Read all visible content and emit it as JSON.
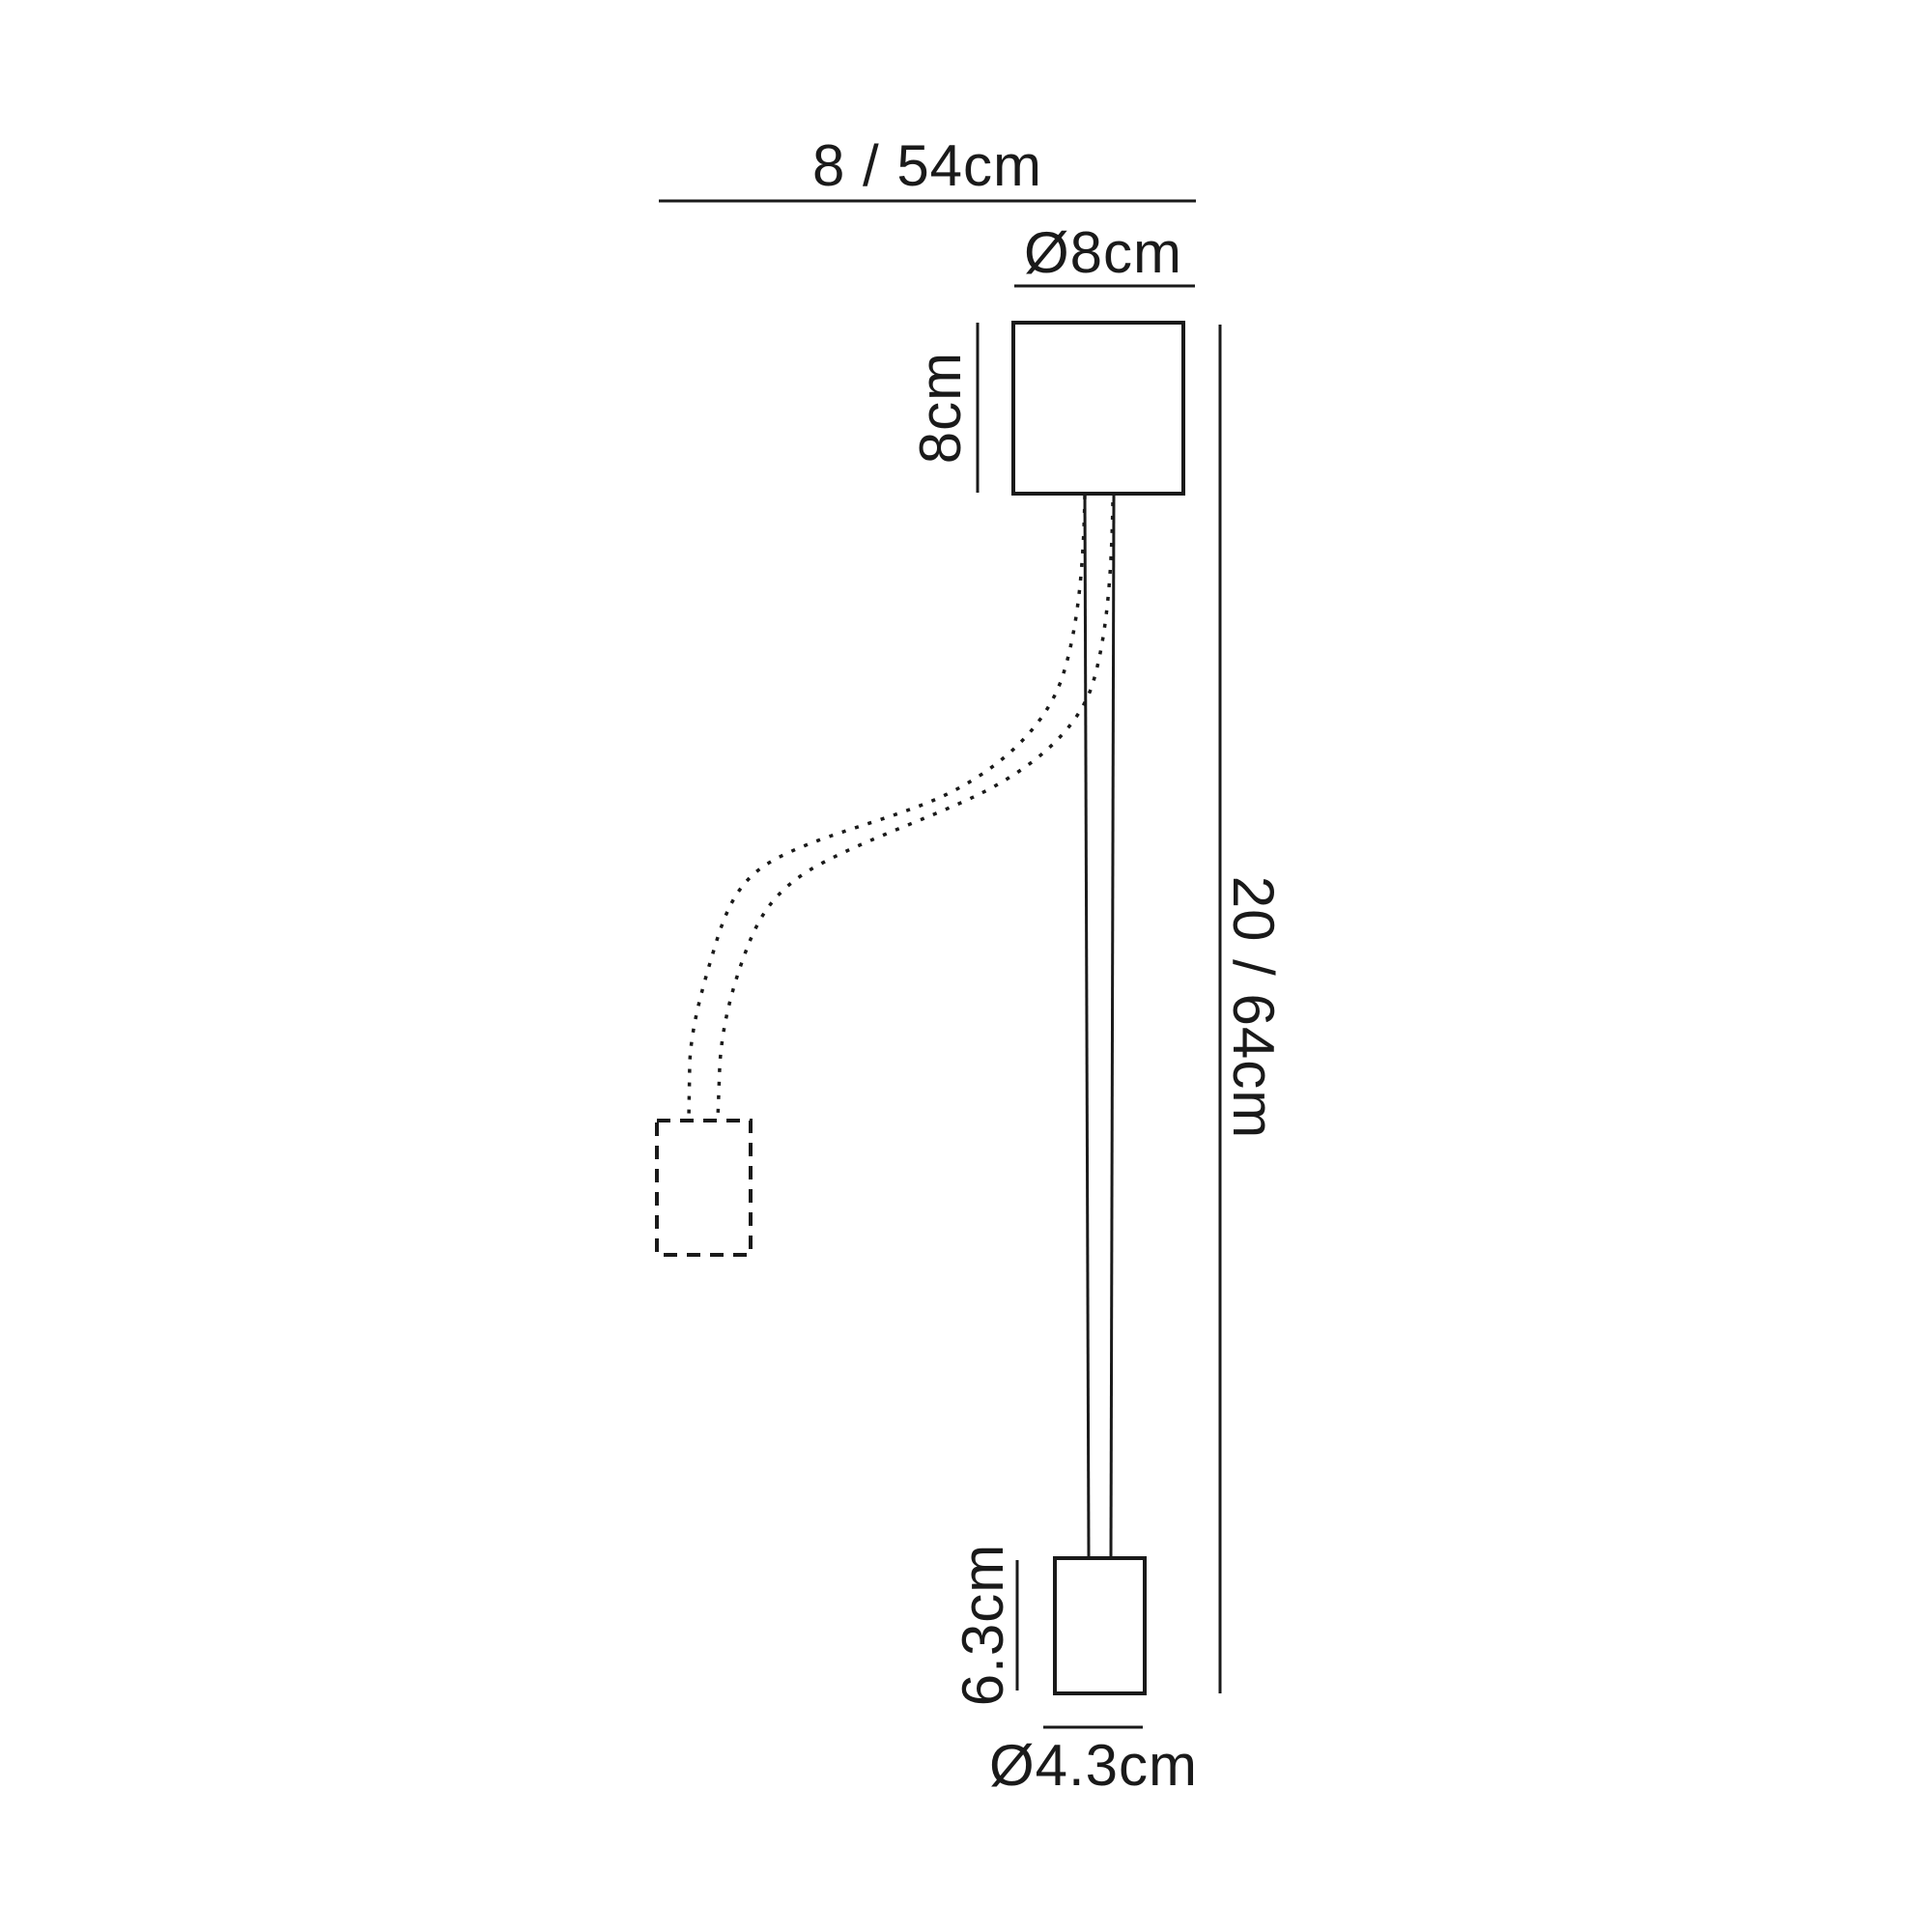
{
  "diagram": {
    "kind": "technical-dimension-drawing",
    "labels": {
      "overall_width": "8 / 54cm",
      "canopy_diameter": "Ø8cm",
      "canopy_height": "8cm",
      "overall_height": "20 / 64cm",
      "head_height": "6.3cm",
      "head_diameter": "Ø4.3cm"
    },
    "colors": {
      "line": "#1a1a1a",
      "background": "#ffffff"
    }
  }
}
